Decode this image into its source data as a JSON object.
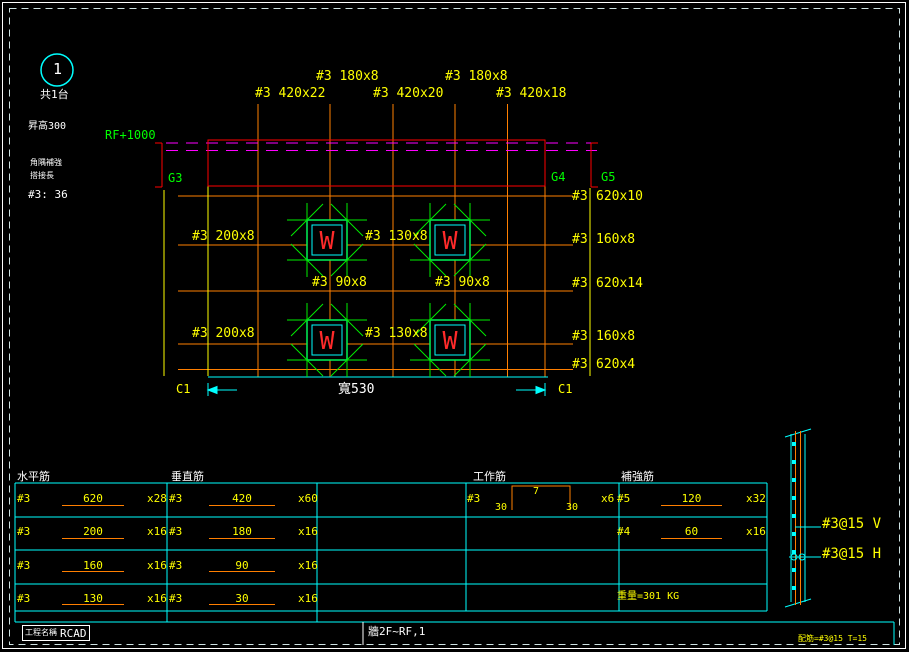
{
  "colors": {
    "grid_orange": "#ff7f00",
    "label_yellow": "#ffff00",
    "line_cyan": "#00ffff",
    "girder_green": "#00ff00",
    "beam_red": "#ff0000",
    "slab_magenta": "#ff00ff",
    "text_white": "#ffffff"
  },
  "callout": {
    "number": "1",
    "count": "共1台"
  },
  "notes": {
    "raise": "昇高300",
    "level": "RF+1000",
    "corner": "角隅補強",
    "lap_label": "搭接長",
    "lap_value": "#3: 36"
  },
  "girders": {
    "g3": "G3",
    "g4": "G4",
    "g5": "G5"
  },
  "plan": {
    "wall_letter": "W",
    "top_labels": [
      "#3 180x8",
      "#3 180x8",
      "#3 420x22",
      "#3 420x20",
      "#3 420x18"
    ],
    "left_labels": [
      "#3 200x8",
      "#3 130x8",
      "#3 200x8",
      "#3 130x8"
    ],
    "corner_labels": [
      "#3 90x8",
      "#3 90x8"
    ],
    "right_labels": [
      {
        "size": "#3",
        "value": "620x10"
      },
      {
        "size": "#3",
        "value": "160x8"
      },
      {
        "size": "#3",
        "value": "620x14"
      },
      {
        "size": "#3",
        "value": "160x8"
      },
      {
        "size": "#3",
        "value": "620x4"
      }
    ],
    "dim": {
      "left_mark": "C1",
      "right_mark": "C1",
      "width": "寬530"
    }
  },
  "table": {
    "headers": [
      "水平筋",
      "垂直筋",
      "工作筋",
      "補強筋"
    ],
    "horizontal_rows": [
      {
        "size": "#3",
        "length": "620",
        "count": "x28"
      },
      {
        "size": "#3",
        "length": "200",
        "count": "x16"
      },
      {
        "size": "#3",
        "length": "160",
        "count": "x16"
      },
      {
        "size": "#3",
        "length": "130",
        "count": "x16"
      }
    ],
    "vertical_rows": [
      {
        "size": "#3",
        "length": "420",
        "count": "x60"
      },
      {
        "size": "#3",
        "length": "180",
        "count": "x16"
      },
      {
        "size": "#3",
        "length": "90",
        "count": "x16"
      },
      {
        "size": "#3",
        "length": "30",
        "count": "x16"
      }
    ],
    "work_row": {
      "size": "#3",
      "top": "7",
      "left": "30",
      "right": "30",
      "count": "x6"
    },
    "extra_rows": [
      {
        "size": "#5",
        "length": "120",
        "count": "x32"
      },
      {
        "size": "#4",
        "length": "60",
        "count": "x16"
      }
    ],
    "weight": "重量=301 KG"
  },
  "section": {
    "v_label": "#3@15 V",
    "h_label": "#3@15 H"
  },
  "titlebar": {
    "project_label": "工程名稱",
    "project_value": "RCAD",
    "sheet_name": "牆2F~RF,1",
    "note": "配筋=#3@15 T=15"
  }
}
